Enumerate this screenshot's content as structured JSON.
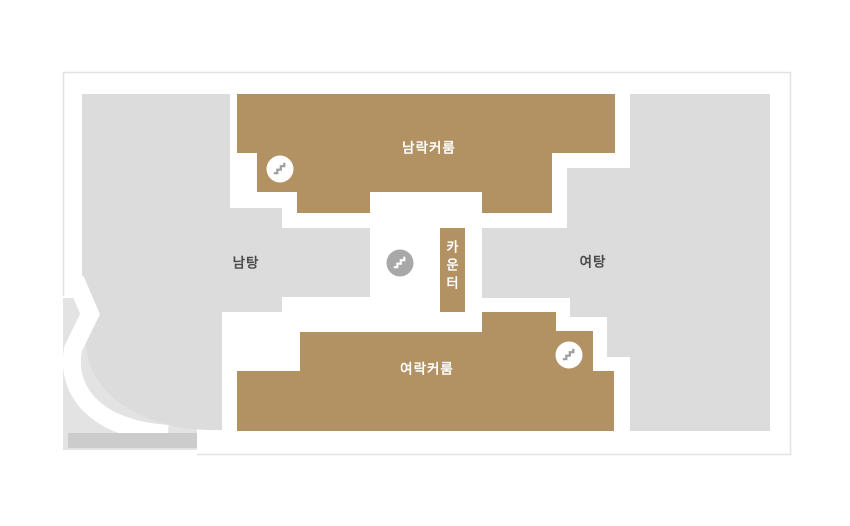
{
  "floor_plan": {
    "rooms": {
      "mens_locker": {
        "label": "남락커룸"
      },
      "mens_bath": {
        "label": "남탕"
      },
      "womens_bath": {
        "label": "여탕"
      },
      "womens_locker": {
        "label": "여락커룸"
      },
      "counter": {
        "label": "카운터",
        "chars": [
          "카",
          "운",
          "터"
        ]
      }
    },
    "icons": {
      "stairs": "stairs"
    },
    "colors": {
      "background": "#ffffff",
      "outline": "#e2e2e2",
      "room_brown": "#b29263",
      "room_gray": "#dcdcdc",
      "terrace_gray": "#e3e3e3",
      "strip_gray": "#cccccc",
      "badge_gray": "#a8a8a8",
      "stairs_gray": "#9d9d9d",
      "label_dark": "#4a4a4a",
      "label_light": "#ffffff",
      "wall_white": "#ffffff"
    }
  }
}
